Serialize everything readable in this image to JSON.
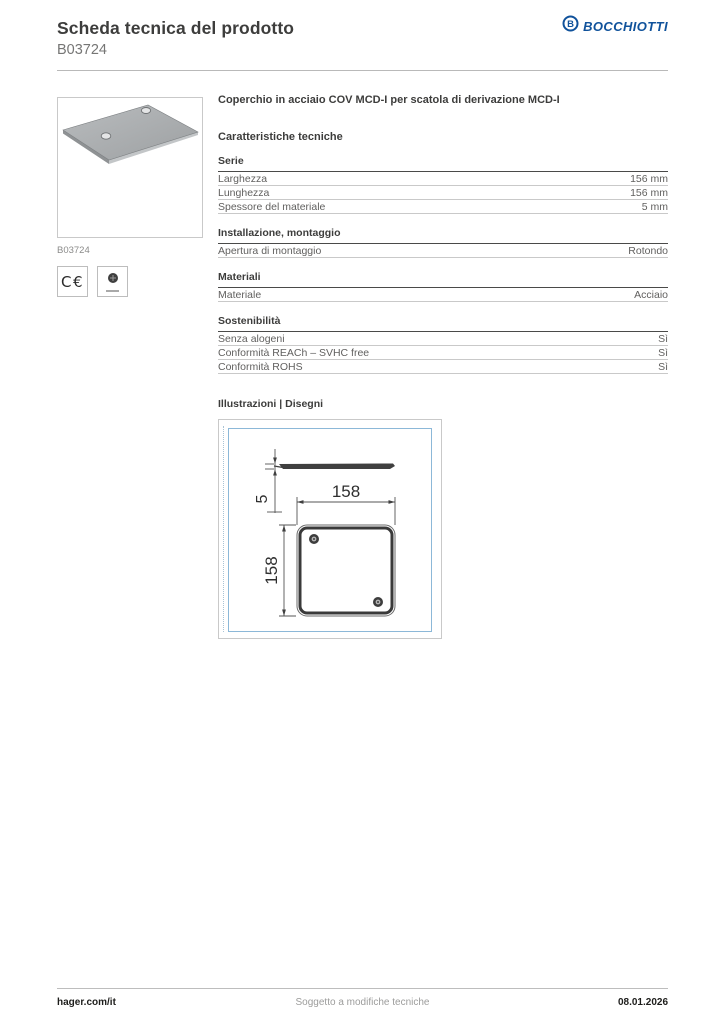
{
  "header": {
    "title": "Scheda tecnica del prodotto",
    "product_code": "B03724",
    "brand": "BOCCHIOTTI",
    "brand_color": "#10529b"
  },
  "product": {
    "image_caption": "B03724",
    "title": "Coperchio in acciaio COV MCD-I per scatola di derivazione MCD-I",
    "certifications": {
      "ce_label": "C€"
    }
  },
  "specs": {
    "section_title": "Caratteristiche tecniche",
    "groups": [
      {
        "title": "Serie",
        "rows": [
          {
            "label": "Larghezza",
            "value": "156 mm"
          },
          {
            "label": "Lunghezza",
            "value": "156 mm"
          },
          {
            "label": "Spessore del materiale",
            "value": "5 mm"
          }
        ]
      },
      {
        "title": "Installazione, montaggio",
        "rows": [
          {
            "label": "Apertura di montaggio",
            "value": "Rotondo"
          }
        ]
      },
      {
        "title": "Materiali",
        "rows": [
          {
            "label": "Materiale",
            "value": "Acciaio"
          }
        ]
      },
      {
        "title": "Sostenibilità",
        "rows": [
          {
            "label": "Senza alogeni",
            "value": "Sì"
          },
          {
            "label": "Conformità REACh – SVHC free",
            "value": "Sì"
          },
          {
            "label": "Conformità ROHS",
            "value": "Sì"
          }
        ]
      }
    ]
  },
  "illustrations": {
    "section_title": "Illustrazioni | Disegni",
    "drawing": {
      "width_label": "158",
      "height_label": "158",
      "thickness_label": "5"
    }
  },
  "footer": {
    "left": "hager.com/it",
    "center": "Soggetto a modifiche tecniche",
    "right": "08.01.2026"
  }
}
